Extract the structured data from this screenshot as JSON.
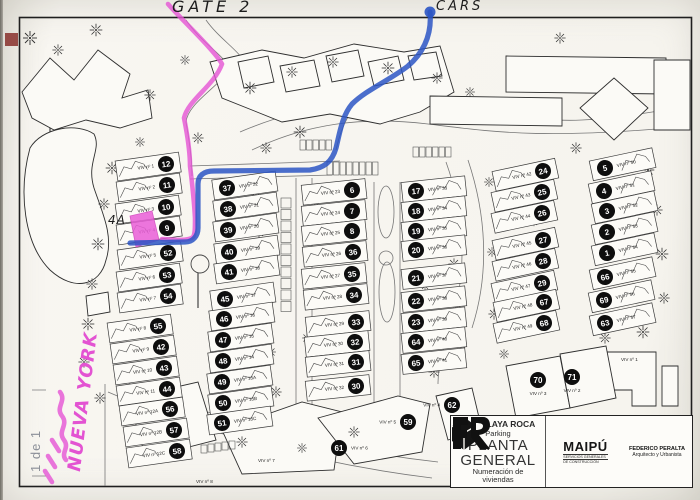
{
  "annotations": {
    "gate": "GATE 2",
    "cars": "CARS",
    "unit": "4A",
    "nueva_york": "NUEVA YORK",
    "sheet": "1 de 1"
  },
  "title_block": {
    "project": "C. P. PLAYA ROCA",
    "subtitle": "Parking",
    "title_line1": "PLANTA",
    "title_line2": "GENERAL",
    "description_line1": "Numeración de",
    "description_line2": "viviendas",
    "maipu": {
      "name": "MAIPÚ",
      "tagline1": "SERVICIOS GENERALES",
      "tagline2": "DE CONSTRUCCIÓN"
    },
    "architect": {
      "name": "FEDERICO PERALTA",
      "role": "Arquitecto y Urbanista"
    }
  },
  "map": {
    "viv_prefix": "VIV nº",
    "columns": [
      {
        "id": "A",
        "labelSide": "left",
        "tilt": -8,
        "rows": [
          {
            "n": "12",
            "viv": "1",
            "x": 166,
            "y": 164
          },
          {
            "n": "11",
            "viv": "2",
            "x": 167,
            "y": 185
          },
          {
            "n": "10",
            "viv": "3",
            "x": 166,
            "y": 207
          },
          {
            "n": "9",
            "viv": "4",
            "x": 167,
            "y": 228
          },
          {
            "n": "52",
            "viv": "5",
            "x": 168,
            "y": 253
          },
          {
            "n": "53",
            "viv": "6",
            "x": 167,
            "y": 275
          },
          {
            "n": "54",
            "viv": "7",
            "x": 168,
            "y": 296
          },
          {
            "n": "55",
            "viv": "8",
            "x": 158,
            "y": 326
          },
          {
            "n": "42",
            "viv": "9",
            "x": 161,
            "y": 347
          },
          {
            "n": "43",
            "viv": "10",
            "x": 164,
            "y": 368
          },
          {
            "n": "44",
            "viv": "11",
            "x": 167,
            "y": 389
          },
          {
            "n": "56",
            "viv": "12A",
            "x": 170,
            "y": 409
          },
          {
            "n": "57",
            "viv": "12B",
            "x": 174,
            "y": 430
          },
          {
            "n": "58",
            "viv": "12C",
            "x": 177,
            "y": 451
          }
        ]
      },
      {
        "id": "B",
        "labelSide": "right",
        "tilt": -8,
        "rows": [
          {
            "n": "37",
            "viv": "22",
            "x": 227,
            "y": 188
          },
          {
            "n": "38",
            "viv": "21",
            "x": 228,
            "y": 209
          },
          {
            "n": "39",
            "viv": "20",
            "x": 228,
            "y": 230
          },
          {
            "n": "40",
            "viv": "19",
            "x": 229,
            "y": 252
          },
          {
            "n": "41",
            "viv": "18",
            "x": 229,
            "y": 272
          },
          {
            "n": "45",
            "viv": "17",
            "x": 225,
            "y": 299
          },
          {
            "n": "46",
            "viv": "16",
            "x": 224,
            "y": 319
          },
          {
            "n": "47",
            "viv": "15",
            "x": 223,
            "y": 340
          },
          {
            "n": "48",
            "viv": "14",
            "x": 223,
            "y": 361
          },
          {
            "n": "49",
            "viv": "13A",
            "x": 222,
            "y": 382
          },
          {
            "n": "50",
            "viv": "13B",
            "x": 223,
            "y": 403
          },
          {
            "n": "51",
            "viv": "13C",
            "x": 222,
            "y": 423
          }
        ]
      },
      {
        "id": "C",
        "labelSide": "left",
        "tilt": -6,
        "rows": [
          {
            "n": "6",
            "viv": "23",
            "x": 352,
            "y": 190
          },
          {
            "n": "7",
            "viv": "24",
            "x": 352,
            "y": 211
          },
          {
            "n": "8",
            "viv": "25",
            "x": 352,
            "y": 231
          },
          {
            "n": "36",
            "viv": "26",
            "x": 353,
            "y": 252
          },
          {
            "n": "35",
            "viv": "27",
            "x": 352,
            "y": 274
          },
          {
            "n": "34",
            "viv": "28",
            "x": 354,
            "y": 295
          },
          {
            "n": "33",
            "viv": "29",
            "x": 356,
            "y": 322
          },
          {
            "n": "32",
            "viv": "30",
            "x": 355,
            "y": 342
          },
          {
            "n": "31",
            "viv": "31",
            "x": 356,
            "y": 362
          },
          {
            "n": "30",
            "viv": "32",
            "x": 356,
            "y": 386
          }
        ]
      },
      {
        "id": "D",
        "labelSide": "right",
        "tilt": -6,
        "rows": [
          {
            "n": "17",
            "viv": "33",
            "x": 416,
            "y": 191
          },
          {
            "n": "18",
            "viv": "34",
            "x": 416,
            "y": 211
          },
          {
            "n": "19",
            "viv": "35",
            "x": 416,
            "y": 231
          },
          {
            "n": "20",
            "viv": "36",
            "x": 416,
            "y": 250
          },
          {
            "n": "21",
            "viv": "37",
            "x": 416,
            "y": 278
          },
          {
            "n": "22",
            "viv": "38",
            "x": 416,
            "y": 301
          },
          {
            "n": "23",
            "viv": "39",
            "x": 416,
            "y": 322
          },
          {
            "n": "64",
            "viv": "40",
            "x": 416,
            "y": 342
          },
          {
            "n": "65",
            "viv": "41",
            "x": 416,
            "y": 363
          }
        ]
      },
      {
        "id": "E",
        "labelSide": "left",
        "tilt": -12,
        "rows": [
          {
            "n": "24",
            "viv": "42",
            "x": 543,
            "y": 171
          },
          {
            "n": "25",
            "viv": "43",
            "x": 542,
            "y": 192
          },
          {
            "n": "26",
            "viv": "44",
            "x": 542,
            "y": 213
          },
          {
            "n": "27",
            "viv": "45",
            "x": 543,
            "y": 240
          },
          {
            "n": "28",
            "viv": "46",
            "x": 543,
            "y": 261
          },
          {
            "n": "29",
            "viv": "47",
            "x": 542,
            "y": 283
          },
          {
            "n": "67",
            "viv": "48",
            "x": 544,
            "y": 302
          },
          {
            "n": "68",
            "viv": "49",
            "x": 544,
            "y": 323
          }
        ]
      },
      {
        "id": "F",
        "labelSide": "right",
        "tilt": -12,
        "rows": [
          {
            "n": "5",
            "viv": "50",
            "x": 605,
            "y": 168
          },
          {
            "n": "4",
            "viv": "51",
            "x": 604,
            "y": 191
          },
          {
            "n": "3",
            "viv": "52",
            "x": 607,
            "y": 211
          },
          {
            "n": "2",
            "viv": "53",
            "x": 607,
            "y": 232
          },
          {
            "n": "1",
            "viv": "54",
            "x": 607,
            "y": 253
          },
          {
            "n": "66",
            "viv": "55",
            "x": 605,
            "y": 277
          },
          {
            "n": "69",
            "viv": "56",
            "x": 604,
            "y": 300
          },
          {
            "n": "63",
            "viv": "57",
            "x": 605,
            "y": 323
          }
        ]
      }
    ],
    "standalone": [
      {
        "n": "61",
        "viv": "6",
        "x": 339,
        "y": 448,
        "labelSide": "right"
      },
      {
        "n": "59",
        "viv": "5",
        "x": 408,
        "y": 422,
        "labelSide": "left"
      },
      {
        "n": "62",
        "viv": "4",
        "x": 452,
        "y": 405,
        "labelSide": "left"
      },
      {
        "n": "70",
        "viv": "3",
        "x": 538,
        "y": 380,
        "labelSide": "below"
      },
      {
        "n": "71",
        "viv": "2",
        "x": 572,
        "y": 377,
        "labelSide": "below"
      }
    ],
    "viv_only": [
      {
        "viv": "1",
        "x": 621,
        "y": 361
      },
      {
        "viv": "7",
        "x": 258,
        "y": 462
      },
      {
        "viv": "8",
        "x": 196,
        "y": 483
      }
    ],
    "base": {
      "roads": [
        "M186,20 C202,44 226,56 230,70 C214,90 188,104 186,122 C190,144 192,160 192,176",
        "M206,20 C220,40 242,52 246,66",
        "M240,132 C300,106 362,98 430,106 C500,114 542,122 582,120 C622,118 662,110 691,106",
        "M252,150 C306,124 362,116 428,124 C494,132 544,140 691,126",
        "M296,178 L296,432",
        "M312,178 L312,420",
        "M374,182 L374,406",
        "M400,182 L400,406",
        "M190,166 L340,161",
        "M190,179 L332,175",
        "M446,162 C464,212 468,268 452,320 C446,340 438,362 438,384",
        "M468,160 C486,214 490,272 472,328",
        "M108,392 C192,428 302,462 432,478",
        "M116,378 C202,414 312,448 438,462",
        "M105,384 L105,486",
        "M336,150 C340,132 346,118 354,108"
      ],
      "buildings": [
        "M22,92 L50,58 L74,80 L98,50 L130,74 L122,98 L148,90 L152,118 L120,128 L86,120 L54,130 L32,118 Z",
        "M30,148 C18,192 24,244 50,270 C74,292 100,286 106,260 C114,236 102,212 94,188 C86,162 102,150 94,134 C76,122 42,128 30,148 Z",
        "M86,296 L108,292 L110,312 L88,316 Z",
        "M210,62 L262,50 L304,58 L354,44 L404,52 L440,46 L454,92 L420,112 L380,124 L330,114 L282,122 L252,110 L222,98 Z",
        "M238,62 L268,56 L274,82 L244,88 Z",
        "M280,66 L314,60 L320,86 L286,92 Z",
        "M326,56 L358,50 L364,76 L332,82 Z",
        "M368,62 L398,56 L404,80 L374,86 Z",
        "M408,56 L436,52 L442,76 L414,80 Z",
        "M506,56 L666,58 L666,94 L506,92 Z",
        "M430,96 L562,98 L562,126 L430,124 Z",
        "M654,60 L690,60 L690,130 L654,130 Z",
        "M614,78 L648,108 L614,140 L580,108 Z",
        "M600,352 L656,352 L656,406 L632,406 L632,390 L600,390 Z",
        "M662,366 L678,366 L678,406 L662,406 Z",
        "M506,366 L560,356 L570,408 L516,418 Z",
        "M560,354 L606,346 L616,398 L570,408 Z",
        "M128,398 L198,382 L216,440 L146,458 Z",
        "M222,430 L302,402 L342,412 L334,470 L242,474 Z",
        "M318,418 L398,396 L430,404 L422,452 L354,464 Z",
        "M436,396 L472,388 L482,430 L448,440 Z"
      ],
      "medians": [
        [
          386,
          212,
          8,
          26
        ],
        [
          387,
          292,
          8,
          30
        ],
        [
          386,
          258,
          7,
          7
        ]
      ],
      "lollipops": [
        [
          52,
          112,
          13,
          50,
          170
        ],
        [
          200,
          264,
          9,
          198,
          308
        ],
        [
          447,
          103,
          7,
          447,
          103
        ]
      ],
      "stalls": [
        {
          "x": 327,
          "y": 162,
          "dx": 6.5,
          "dy": 0,
          "w": 5.5,
          "h": 13,
          "n": 8
        },
        {
          "x": 413,
          "y": 147,
          "dx": 6.5,
          "dy": 0,
          "w": 5.5,
          "h": 10,
          "n": 6
        },
        {
          "x": 281,
          "y": 198,
          "dx": 0,
          "dy": 11.5,
          "w": 10,
          "h": 10,
          "n": 10
        },
        {
          "x": 201,
          "y": 445,
          "dx": 7,
          "dy": -1,
          "w": 6,
          "h": 8,
          "n": 5
        },
        {
          "x": 300,
          "y": 140,
          "dx": 6.5,
          "dy": 0,
          "w": 5.5,
          "h": 10,
          "n": 5
        }
      ],
      "trees": [
        [
          30,
          38,
          1
        ],
        [
          58,
          50,
          0.8
        ],
        [
          96,
          30,
          0.9
        ],
        [
          150,
          95,
          0.8
        ],
        [
          185,
          60,
          0.7
        ],
        [
          250,
          88,
          0.9
        ],
        [
          292,
          72,
          0.8
        ],
        [
          333,
          62,
          0.8
        ],
        [
          388,
          68,
          0.9
        ],
        [
          437,
          78,
          0.8
        ],
        [
          470,
          92,
          0.7
        ],
        [
          560,
          38,
          0.8
        ],
        [
          300,
          132,
          0.9
        ],
        [
          266,
          148,
          0.8
        ],
        [
          198,
          138,
          0.8
        ],
        [
          140,
          142,
          0.7
        ],
        [
          112,
          168,
          0.9
        ],
        [
          104,
          204,
          0.8
        ],
        [
          98,
          244,
          0.9
        ],
        [
          92,
          284,
          0.8
        ],
        [
          88,
          324,
          0.9
        ],
        [
          84,
          362,
          0.8
        ],
        [
          100,
          398,
          0.8
        ],
        [
          256,
          192,
          0.7
        ],
        [
          259,
          232,
          0.8
        ],
        [
          263,
          272,
          0.7
        ],
        [
          267,
          312,
          0.8
        ],
        [
          271,
          352,
          0.7
        ],
        [
          276,
          392,
          0.8
        ],
        [
          316,
          206,
          0.6
        ],
        [
          312,
          250,
          0.7
        ],
        [
          309,
          294,
          0.6
        ],
        [
          307,
          338,
          0.7
        ],
        [
          448,
          184,
          0.8
        ],
        [
          451,
          224,
          0.7
        ],
        [
          454,
          264,
          0.8
        ],
        [
          457,
          304,
          0.7
        ],
        [
          461,
          344,
          0.8
        ],
        [
          489,
          182,
          0.7
        ],
        [
          576,
          148,
          0.8
        ],
        [
          648,
          170,
          0.9
        ],
        [
          657,
          210,
          0.8
        ],
        [
          662,
          254,
          0.9
        ],
        [
          664,
          298,
          0.8
        ],
        [
          643,
          332,
          0.9
        ],
        [
          605,
          338,
          0.8
        ],
        [
          494,
          314,
          0.8
        ],
        [
          504,
          354,
          0.7
        ],
        [
          434,
          372,
          0.8
        ],
        [
          354,
          432,
          0.8
        ],
        [
          302,
          448,
          0.7
        ],
        [
          242,
          442,
          0.8
        ],
        [
          418,
          198,
          0.6
        ],
        [
          422,
          242,
          0.6
        ],
        [
          425,
          286,
          0.6
        ],
        [
          492,
          252,
          0.7
        ],
        [
          530,
          180,
          0.6
        ],
        [
          534,
          222,
          0.6
        ],
        [
          537,
          264,
          0.6
        ],
        [
          540,
          306,
          0.6
        ]
      ]
    },
    "markers": {
      "pink_color": "#e554d4",
      "blue_color": "#2b55c4",
      "pink_path": "M168,4 C182,20 214,50 222,64 C214,86 188,100 184,118 C188,138 190,152 190,166 C192,182 194,200 195,218 C195,228 195,234 193,237 C188,241 176,240 162,239",
      "pink_house": "130,216 152,211 159,240 136,247",
      "blue_path": "M430,12 C432,34 424,52 408,66 C390,80 366,90 352,104 C342,116 340,132 336,148 C332,162 324,168 310,170 L214,171 C203,171 198,176 198,184 L198,228 C198,236 193,242 185,242 L130,243",
      "blue_start": [
        430,
        12,
        5.5
      ],
      "pink_squiggle": "M60,392 c7,9 -5,15 2,24 c7,9 -5,15 2,24 c6,8 -4,13 2,20",
      "pink_dashes": [
        "M52,440 l7,11",
        "M48,456 l7,11",
        "M45,471 l7,11"
      ]
    }
  }
}
